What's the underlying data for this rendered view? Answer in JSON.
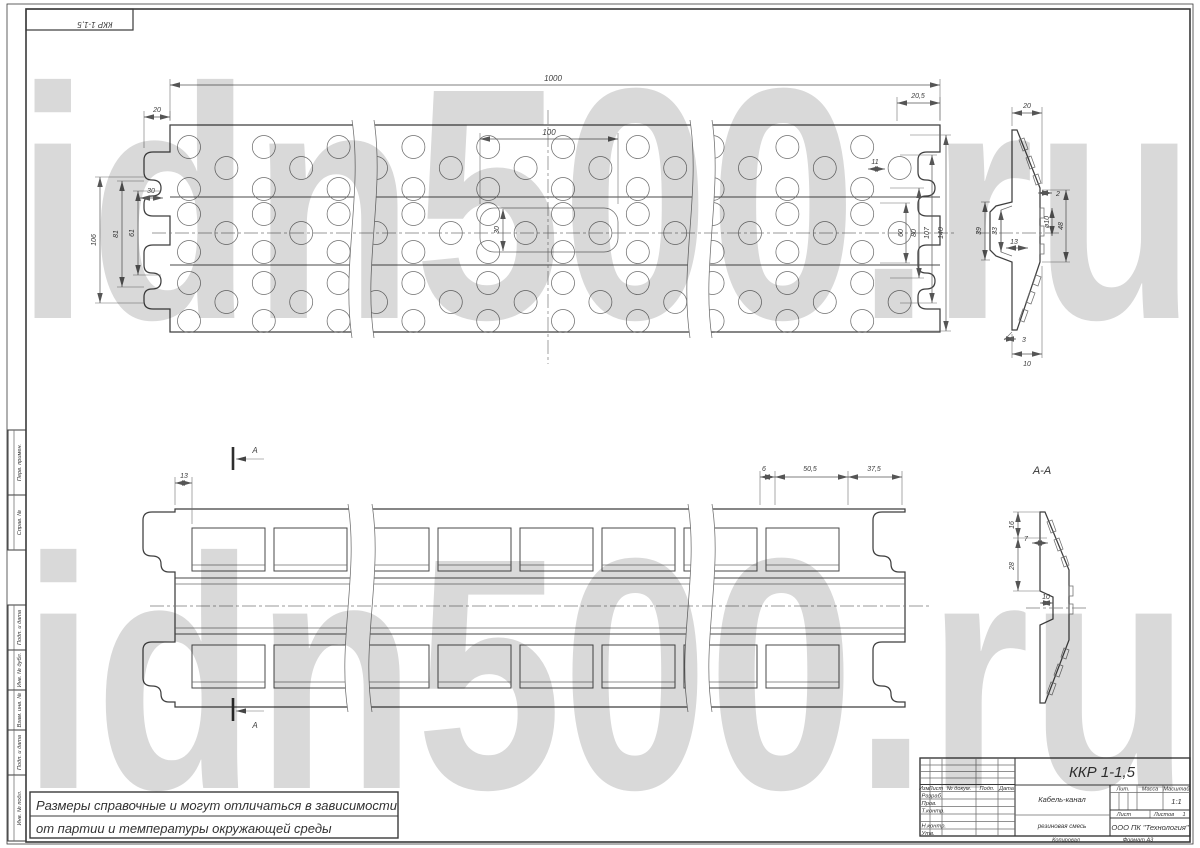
{
  "watermark": {
    "text": "idn500.ru",
    "color": "#d9d9d9"
  },
  "corner_stamp": {
    "designation": "ККР 1-1,5"
  },
  "side_columns": [
    {
      "label": "Перв. примен."
    },
    {
      "label": "Справ. №"
    },
    {
      "label": "Подп. и дата"
    },
    {
      "label": "Инв. № дубл."
    },
    {
      "label": "Взам. инв. №"
    },
    {
      "label": "Подп. и дата"
    },
    {
      "label": "Инв. № подл."
    }
  ],
  "note": {
    "line1": "Размеры справочные и могут отличаться в зависимости",
    "line2": "от партии и температуры окружающей среды"
  },
  "top_view": {
    "dims": {
      "length": "1000",
      "slot_span": "100",
      "left_offset": "20",
      "right_offset": "20,5",
      "tab_width": "30",
      "left_106": "106",
      "left_81": "81",
      "left_61": "61",
      "right_11": "11",
      "right_60": "60",
      "right_80": "80",
      "right_107": "107",
      "right_140": "140",
      "slot_height": "30"
    }
  },
  "end_view": {
    "dims": {
      "top_width": "20",
      "rib": "2",
      "hole_dia": "ø10",
      "mid_height": "48",
      "cavity_outer": "39",
      "cavity_inner": "33",
      "cavity_half": "13",
      "bottom_small": "3",
      "bottom_width": "10"
    }
  },
  "bottom_view": {
    "section_label": "А",
    "dims": {
      "left_13": "13",
      "d6": "6",
      "d50_5": "50,5",
      "d37_5": "37,5"
    }
  },
  "section_view": {
    "title": "А-А",
    "dims": {
      "d16": "16",
      "d7": "7",
      "d28": "28",
      "d10": "10"
    }
  },
  "title_block": {
    "designation": "ККР 1-1,5",
    "name": "Кабель-канал",
    "material": "резиновая смесь",
    "company": "ООО ПК \"Технология\"",
    "header": {
      "izm": "Изм.",
      "list": "Лист",
      "doc": "№ докум.",
      "podp": "Подп.",
      "data": "Дата"
    },
    "rows": [
      {
        "label": "Разраб."
      },
      {
        "label": "Пров."
      },
      {
        "label": "Т.контр."
      },
      {
        "label": ""
      },
      {
        "label": "Н.контр."
      },
      {
        "label": "Утв."
      }
    ],
    "lit_label": "Лит.",
    "mass_label": "Масса",
    "scale_label": "Масштаб",
    "scale_value": "1:1",
    "sheet_label": "Лист",
    "sheets_label": "Листов",
    "sheets_value": "1",
    "copied": "Копировал",
    "format": "Формат  А3"
  }
}
